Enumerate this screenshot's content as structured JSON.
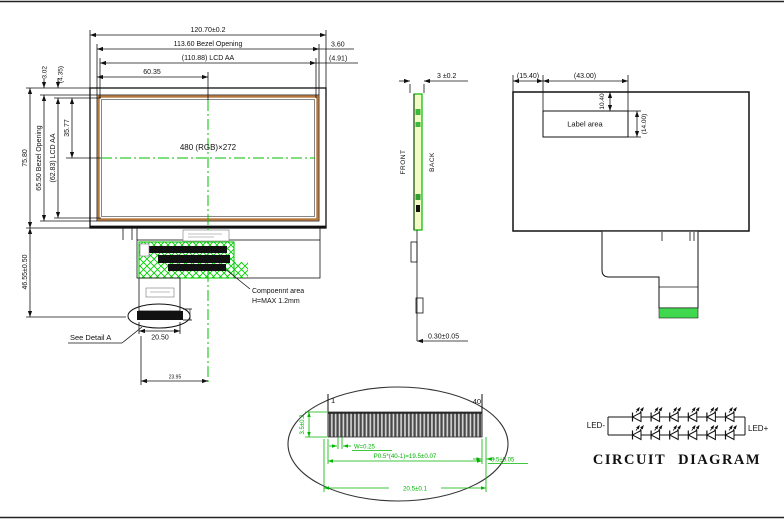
{
  "front_view": {
    "dim_overall_width": "120.70±0.2",
    "dim_bezel_opening_w": "113.60 Bezel Opening",
    "dim_lcd_aa_w": "(110.88) LCD AA",
    "dim_center_x": "60.35",
    "dim_right_gap": "3.60",
    "dim_right_gap_aa": "(4.91)",
    "dim_top_gap": "3.02",
    "dim_top_gap_aa": "(4.35)",
    "dim_overall_height": "75.80",
    "dim_bezel_opening_h": "65.50 Bezel Opening",
    "dim_lcd_aa_h": "(62.83) LCD AA",
    "dim_center_y": "35.77",
    "dim_tail_height": "46.55±0.50",
    "resolution_label": "480 (RGB)×272",
    "component_area_line1": "Compoennt area",
    "component_area_line2": "H=MAX 1.2mm",
    "see_detail_label": "See Detail A",
    "dim_connector_width": "20.50",
    "dim_tail_offset": "23.95"
  },
  "side_view": {
    "dim_thickness": "3 ±0.2",
    "label_front": "FRONT",
    "label_back": "BACK",
    "dim_fpc_thickness": "0.30±0.05"
  },
  "back_view": {
    "dim_label_left": "(15.40)",
    "dim_label_width": "(43.00)",
    "dim_label_top": "10.40",
    "dim_label_height": "(14.00)",
    "label_area": "Label area"
  },
  "detail_a": {
    "pin_first": "1",
    "pin_last": "40",
    "dim_pin_length": "3.5±0.2",
    "dim_pin_width": "W=0.25",
    "dim_pitch": "P0.5*(40-1)=19.5±0.07",
    "dim_edge_margin": "0.5±0.05",
    "dim_total_width": "20.5±0.1"
  },
  "circuit_diagram": {
    "label_negative": "LED-",
    "label_positive": "LED+",
    "title": "CIRCUIT DIAGRAM",
    "leds_per_branch": 6,
    "branches": 2
  },
  "colors": {
    "annotation_green": "#00b400",
    "bezel_orange": "#b5773c",
    "stiffener_green": "#3fd84f",
    "glass_fill": "#f3fbc4"
  }
}
